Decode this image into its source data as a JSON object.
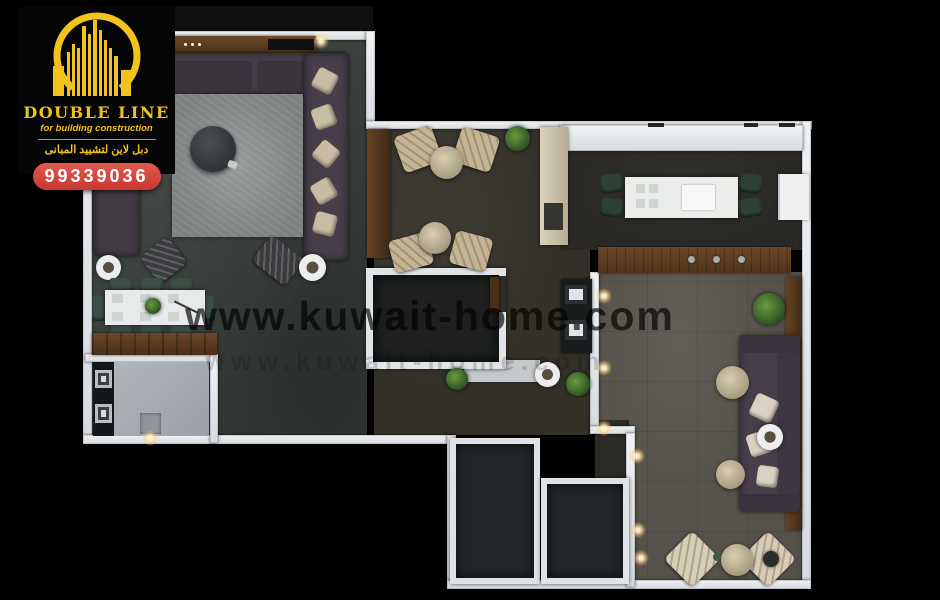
{
  "branding": {
    "logo_title": "DOUBLE LINE",
    "logo_subtitle": "for building construction",
    "logo_arabic": "دبل لاين لتشييد المبانى",
    "phone": "99339036"
  },
  "watermark": {
    "text": "www.kuwait-home.com"
  },
  "palette": {
    "background": "#000000",
    "wall": "#e2e5e8",
    "gold": "#f2c21d",
    "badge_red": "#d9413a",
    "floor_majlis": "#3c423e",
    "floor_middle": "#343129",
    "floor_kitchen": "#2a2925",
    "floor_living": "#55524b",
    "floor_utility": "#a7acb1",
    "floor_dark_rooms": "#24272a",
    "rug": "#8a908f",
    "wood": "#5d3e23",
    "sofa": "#463f49",
    "beige_chair": "#c4b394",
    "green_chair": "#3c4f46",
    "plant_green": "#3f6b2e",
    "white_furniture": "#eaecea"
  }
}
